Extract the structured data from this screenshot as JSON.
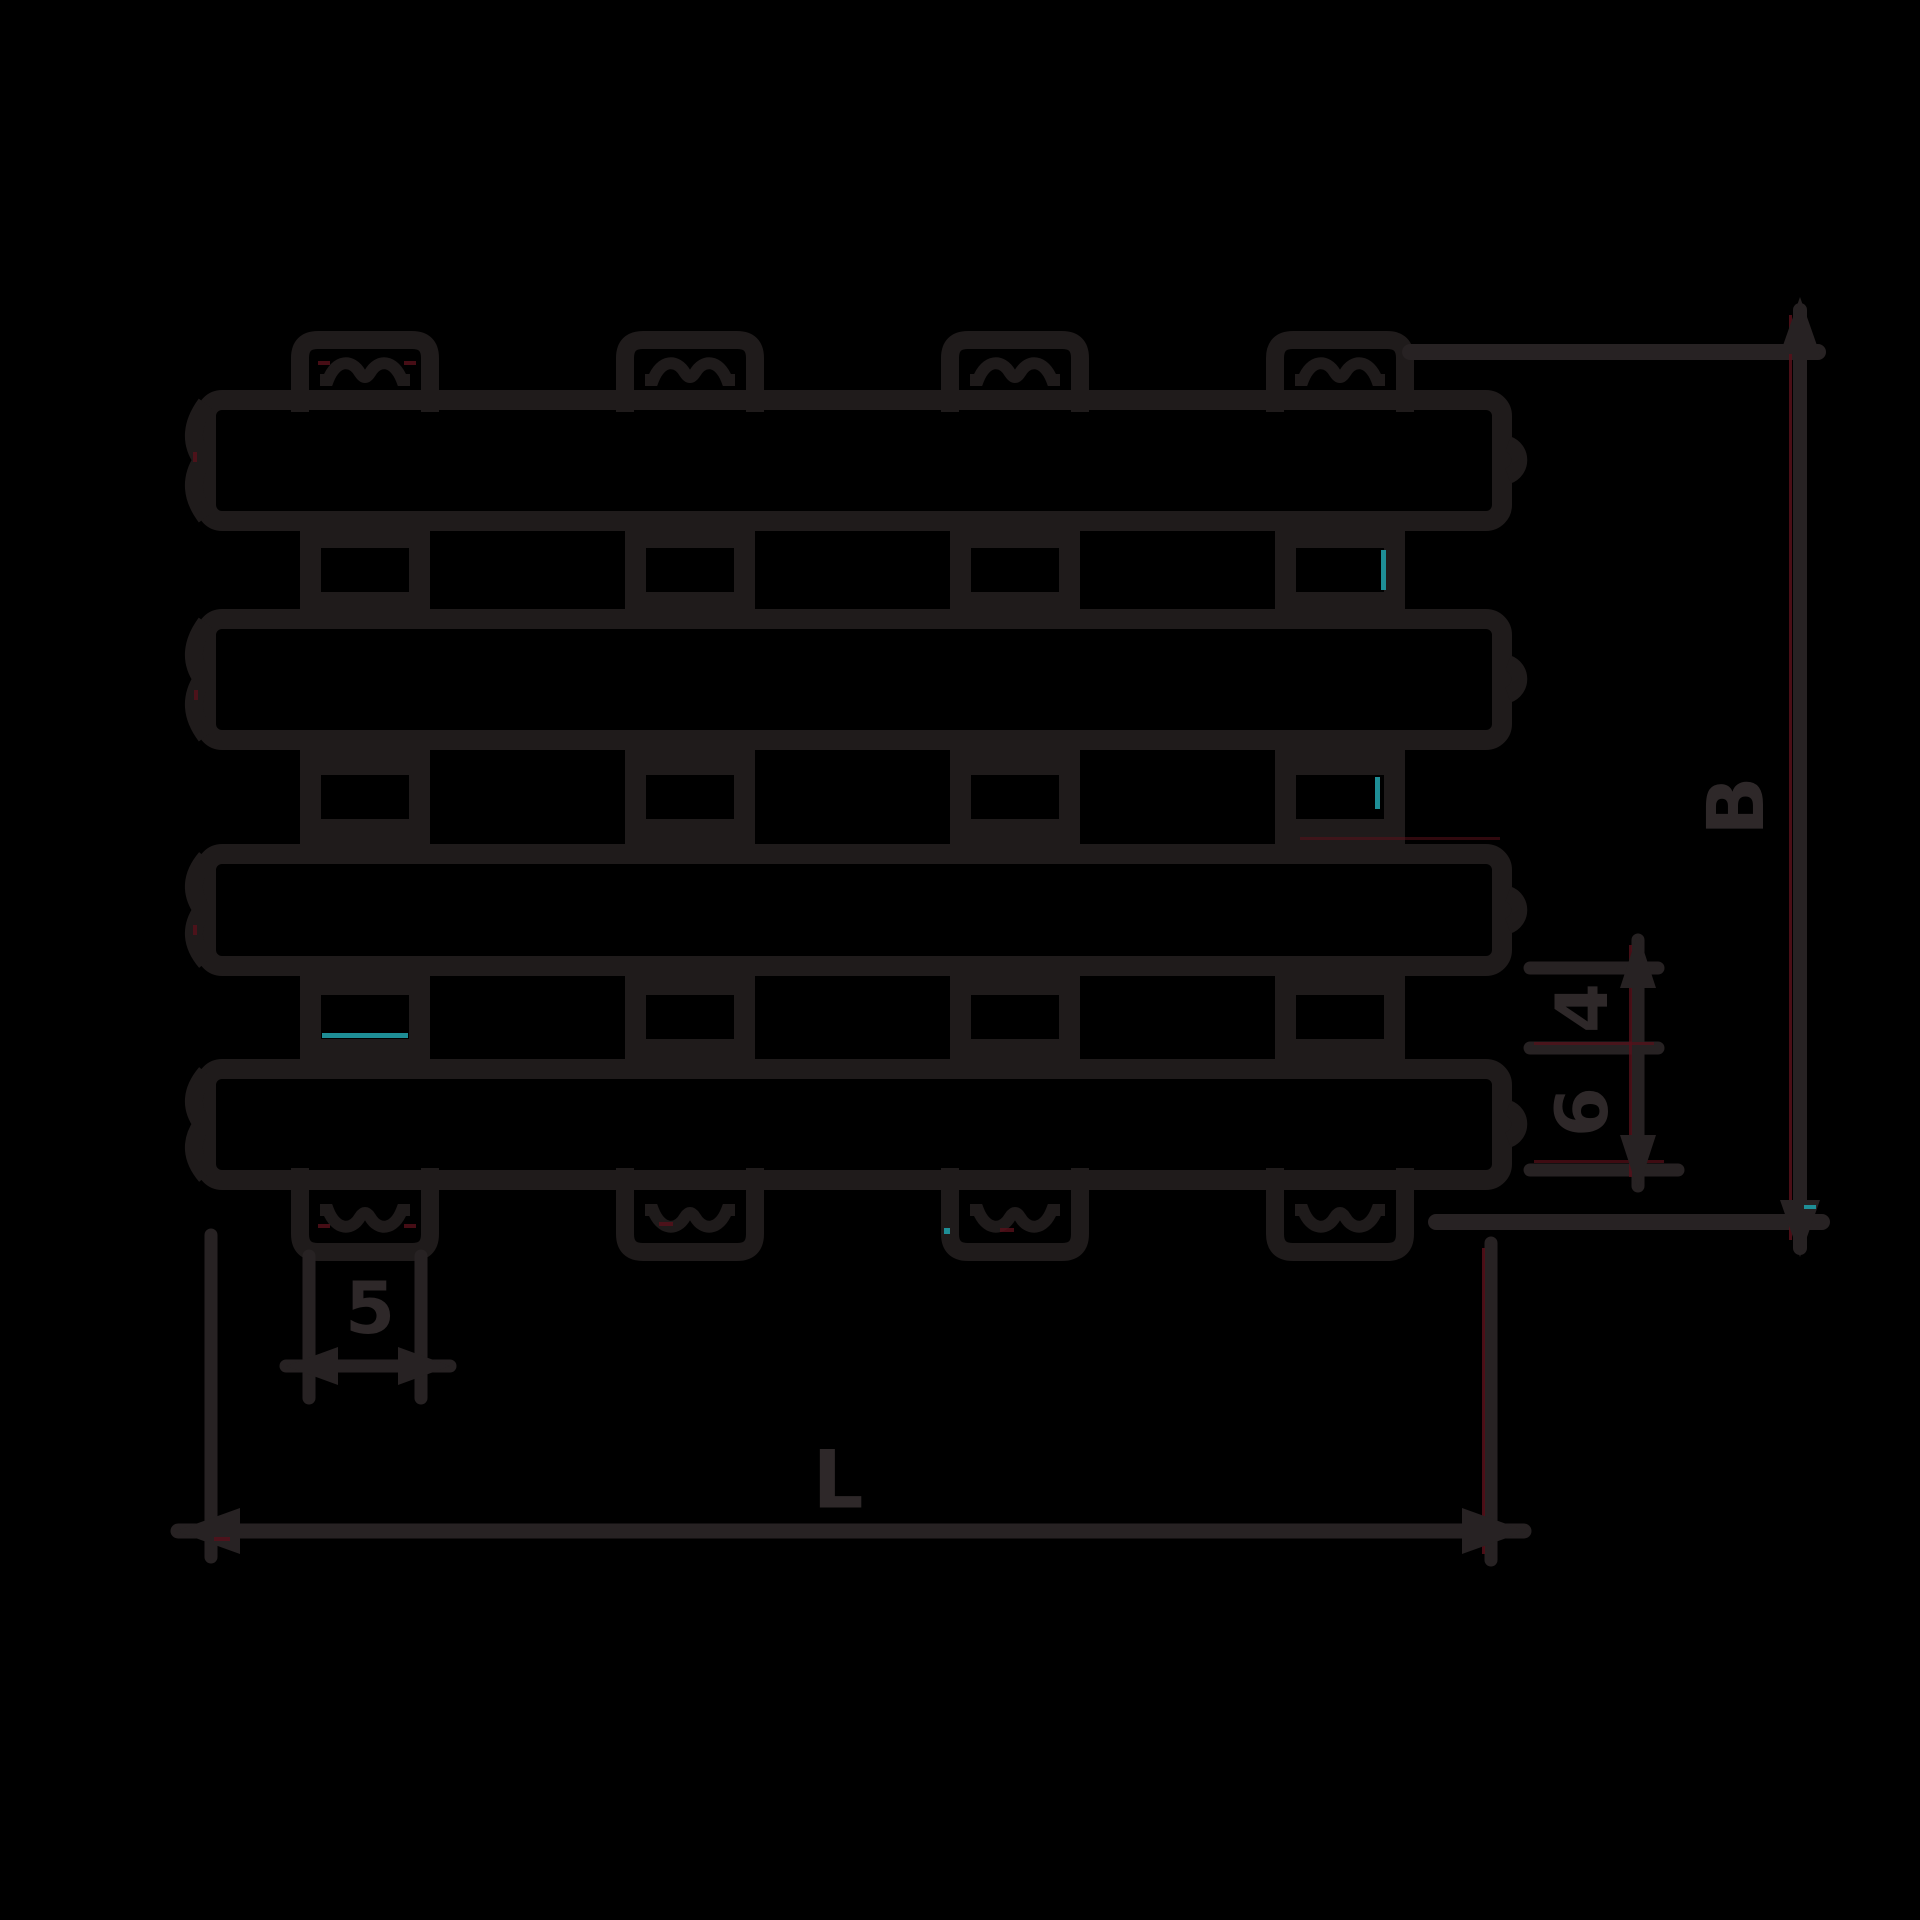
{
  "drawing": {
    "kind": "technical-dimension-drawing",
    "labels": {
      "length": "L",
      "overall_height": "B",
      "gap": "4",
      "lug_width": "5",
      "slat_thickness": "6"
    },
    "colors": {
      "background": "#000000",
      "body_line": "#1f1b1b",
      "dimension_line": "#272223",
      "label_text": "#2e2829",
      "accent_teal": "#1e8e96",
      "accent_red": "#58101a"
    }
  }
}
